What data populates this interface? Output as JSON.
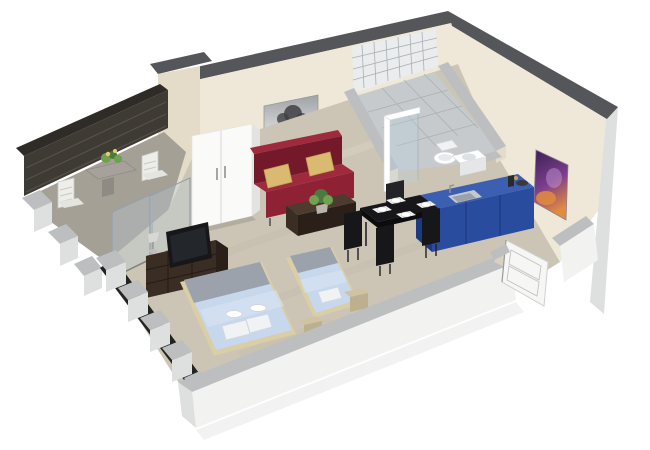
{
  "meta": {
    "type": "3d-floor-plan-render",
    "view": "isometric cutaway",
    "background": "#FFFFFF"
  },
  "scene": {
    "description": "Isometric 3D cutaway render of a studio apartment: balcony with outdoor table, living-sleeping room with red sofa, wardrobe, TV sideboard and two blue beds, black dining set, blue kitchenette counter, tiled bathroom with shower, toilet and washbasin, and a white entrance door",
    "rooms": [
      {
        "id": "balcony",
        "label": "Balcony terrace",
        "features": [
          "dark slatted back wall",
          "concrete floor",
          "stone table with flowers",
          "two white slatted chairs",
          "glass sliding door"
        ]
      },
      {
        "id": "living-sleeping",
        "label": "Living and sleeping room",
        "features": [
          "travertine floor",
          "white two-door wardrobe",
          "black and white tree artwork",
          "dark red sofa with two tan pillows",
          "dark wood coffee table with plant",
          "TV on dark sideboard with lamp",
          "double bed with light blue bedding",
          "single bed with light blue bedding",
          "beige nightstands",
          "cutaway window wall"
        ]
      },
      {
        "id": "dining-kitchen",
        "label": "Dining and kitchenette",
        "features": [
          "black dining table with four place settings",
          "black chairs",
          "blue kitchen counter with inset sink and faucet",
          "counter-top bottle and bowl"
        ]
      },
      {
        "id": "bathroom",
        "label": "Bathroom",
        "features": [
          "white tiled shower wall",
          "glass shower screen with white frame",
          "toilet",
          "washbasin cabinet",
          "gray tiled floor"
        ]
      },
      {
        "id": "entrance",
        "label": "Entrance",
        "features": [
          "white panelled door in recess",
          "tan threshold"
        ]
      }
    ],
    "counts": {
      "beds": 2,
      "sofa_pillows": 2,
      "dining_place_settings": 4,
      "dining_chairs": 4,
      "balcony_chairs": 2,
      "wall_artworks": 2,
      "wardrobe_doors": 2
    }
  },
  "palette": {
    "wallCream": "#EFE8D8",
    "wallCreamShade": "#E4DCC9",
    "wallTopDark": "#55565A",
    "wallTopLight": "#BCBEC0",
    "outerWhite": "#F2F2F1",
    "outerShade": "#DEDFDF",
    "floorMain": "#CCC5B5",
    "floorMottleDark": "#BFB7A6",
    "floorMottleLight": "#D7D0C2",
    "floorBalcony": "#A5A096",
    "balconyWall": "#3E3A34",
    "balconySlat": "#57514A",
    "bathFloor": "#C6CACD",
    "tileWhite": "#EAECEE",
    "grout": "#AAB0B5",
    "glassFill": "rgba(185,210,225,0.30)",
    "glassEdge": "#96A0A8",
    "sofaRed": "#8E2133",
    "sofaRedDark": "#73192A",
    "sofaRedLight": "#9F2A3D",
    "pillowTan": "#D9BA70",
    "wood": "#3A2D24",
    "woodLight": "#4C3B2E",
    "woodDark": "#2A2019",
    "black": "#17171A",
    "blackSoft": "#242428",
    "kitchenBlue": "#2A4C9F",
    "kitchenBlueTop": "#3D5FB2",
    "kitchenBlueDark": "#1E3A7F",
    "steel": "#C4C9CE",
    "steelDark": "#9AA1A8",
    "white": "#FFFFFF",
    "offWhite": "#F0F2F4",
    "bedBlue": "#C7D8ED",
    "bedBlueLight": "#D8E4F4",
    "bedGray": "#9BA2AB",
    "bedFrame": "#D9CEA4",
    "nightstand": "#CFC3A2",
    "nightstandDark": "#BDB08E",
    "doorWhite": "#F6F6F5",
    "artPurpleDark": "#3A2152",
    "artPurple": "#7A3C8C",
    "artOrange": "#E28B3E",
    "treeDark": "#3F4043",
    "green": "#4C7A3C",
    "greenLight": "#6FA150",
    "flowerYellow": "#E6CF6B"
  }
}
